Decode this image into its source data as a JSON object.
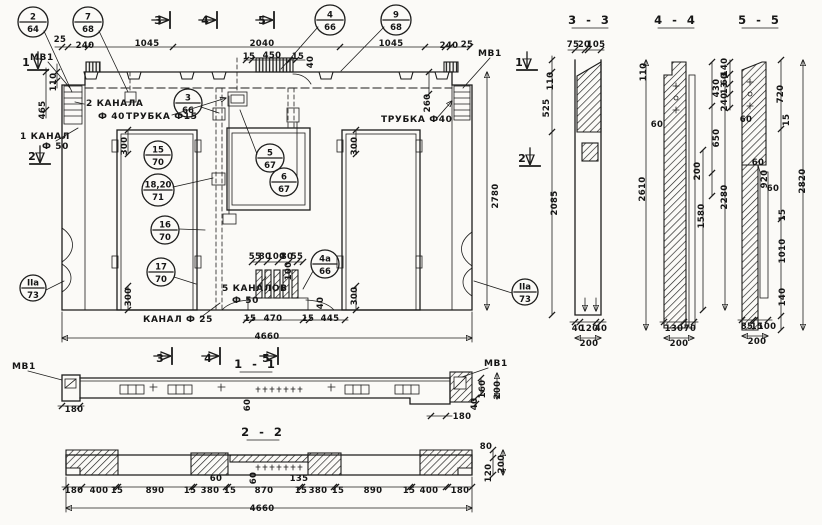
{
  "meta": {
    "bg": "#fbfaf7",
    "ink": "#1c1c1b",
    "drawing_type": "panel-working-drawing"
  },
  "drawing": {
    "balloons": [
      {
        "top": "2",
        "bot": "64",
        "cx": 33,
        "cy": 22,
        "r": 15
      },
      {
        "top": "7",
        "bot": "68",
        "cx": 88,
        "cy": 22,
        "r": 15
      },
      {
        "top": "4",
        "bot": "66",
        "cx": 330,
        "cy": 20,
        "r": 15
      },
      {
        "top": "9",
        "bot": "68",
        "cx": 396,
        "cy": 20,
        "r": 15
      },
      {
        "top": "3",
        "bot": "66",
        "cx": 188,
        "cy": 103,
        "r": 14
      },
      {
        "top": "15",
        "bot": "70",
        "cx": 158,
        "cy": 155,
        "r": 14
      },
      {
        "top": "18,20",
        "bot": "71",
        "cx": 158,
        "cy": 190,
        "r": 16
      },
      {
        "top": "16",
        "bot": "70",
        "cx": 165,
        "cy": 230,
        "r": 14
      },
      {
        "top": "17",
        "bot": "70",
        "cx": 161,
        "cy": 272,
        "r": 14
      },
      {
        "top": "5",
        "bot": "67",
        "cx": 270,
        "cy": 158,
        "r": 14
      },
      {
        "top": "6",
        "bot": "67",
        "cx": 284,
        "cy": 182,
        "r": 14
      },
      {
        "top": "4а",
        "bot": "66",
        "cx": 325,
        "cy": 264,
        "r": 14
      },
      {
        "top": "IIа",
        "bot": "73",
        "cx": 33,
        "cy": 288,
        "r": 13
      },
      {
        "top": "IIа",
        "bot": "73",
        "cx": 525,
        "cy": 292,
        "r": 13
      }
    ],
    "texts": [
      {
        "t": "25",
        "x": 60,
        "y": 42
      },
      {
        "t": "240",
        "x": 85,
        "y": 48
      },
      {
        "t": "1045",
        "x": 147,
        "y": 46
      },
      {
        "t": "2040",
        "x": 262,
        "y": 46
      },
      {
        "t": "1045",
        "x": 391,
        "y": 46
      },
      {
        "t": "240",
        "x": 449,
        "y": 48
      },
      {
        "t": "25",
        "x": 467,
        "y": 47
      },
      {
        "t": "15",
        "x": 249,
        "y": 59
      },
      {
        "t": "450",
        "x": 272,
        "y": 58
      },
      {
        "t": "15",
        "x": 298,
        "y": 59
      },
      {
        "t": "40",
        "x": 313,
        "y": 62,
        "r": 1
      },
      {
        "t": "3",
        "x": 158,
        "y": 24,
        "c": "mark",
        "n": "section-mark-3-top"
      },
      {
        "t": "4",
        "x": 205,
        "y": 24,
        "c": "mark",
        "n": "section-mark-4-top"
      },
      {
        "t": "5",
        "x": 262,
        "y": 24,
        "c": "mark",
        "n": "section-mark-5-top"
      },
      {
        "t": "1",
        "x": 26,
        "y": 66,
        "c": "mark",
        "n": "section-mark-1-left"
      },
      {
        "t": "2",
        "x": 32,
        "y": 160,
        "c": "mark",
        "n": "section-mark-2-left"
      },
      {
        "t": "1",
        "x": 519,
        "y": 66,
        "c": "mark",
        "n": "section-mark-1-right"
      },
      {
        "t": "2",
        "x": 522,
        "y": 162,
        "c": "mark",
        "n": "section-mark-2-right"
      },
      {
        "t": "МВ1",
        "x": 30,
        "y": 60,
        "c": "lbl",
        "n": "label-mv1-top-left"
      },
      {
        "t": "МВ1",
        "x": 478,
        "y": 56,
        "c": "lbl",
        "n": "label-mv1-top-right"
      },
      {
        "t": "110",
        "x": 56,
        "y": 82,
        "r": 1
      },
      {
        "t": "465",
        "x": 45,
        "y": 110,
        "r": 1
      },
      {
        "t": "2 КАНАЛА",
        "x": 86,
        "y": 106,
        "c": "lbl",
        "n": "label-2-channels"
      },
      {
        "t": "Ф 40",
        "x": 98,
        "y": 119,
        "c": "lbl",
        "n": "label-2-channels-dia"
      },
      {
        "t": "ТРУБКА Ф15",
        "x": 126,
        "y": 119,
        "c": "lbl",
        "n": "label-tube-15"
      },
      {
        "t": "1 КАНАЛ",
        "x": 20,
        "y": 139,
        "c": "lbl",
        "n": "label-1-channel"
      },
      {
        "t": "Ф 50",
        "x": 42,
        "y": 149,
        "c": "lbl",
        "n": "label-1-channel-dia"
      },
      {
        "t": "ТРУБКА Ф40",
        "x": 381,
        "y": 122,
        "c": "lbl",
        "n": "label-tube-40"
      },
      {
        "t": "260",
        "x": 430,
        "y": 103,
        "r": 1
      },
      {
        "t": "300",
        "x": 127,
        "y": 146,
        "r": 1
      },
      {
        "t": "300",
        "x": 131,
        "y": 297,
        "r": 1
      },
      {
        "t": "300",
        "x": 357,
        "y": 146,
        "r": 1
      },
      {
        "t": "300",
        "x": 357,
        "y": 296,
        "r": 1
      },
      {
        "t": "2780",
        "x": 498,
        "y": 196,
        "r": 1
      },
      {
        "t": "55",
        "x": 255,
        "y": 259
      },
      {
        "t": "80",
        "x": 265,
        "y": 259
      },
      {
        "t": "100",
        "x": 276,
        "y": 259
      },
      {
        "t": "80",
        "x": 287,
        "y": 259
      },
      {
        "t": "55",
        "x": 297,
        "y": 259
      },
      {
        "t": "100",
        "x": 291,
        "y": 271,
        "r": 1
      },
      {
        "t": "5 КАНАЛОВ",
        "x": 222,
        "y": 291,
        "c": "lbl",
        "n": "label-5-channels"
      },
      {
        "t": "Ф 50",
        "x": 232,
        "y": 303,
        "c": "lbl",
        "n": "label-5-channels-dia"
      },
      {
        "t": "КАНАЛ Ф 25",
        "x": 143,
        "y": 322,
        "c": "lbl",
        "n": "label-channel-25"
      },
      {
        "t": "40",
        "x": 323,
        "y": 303,
        "r": 1
      },
      {
        "t": "15",
        "x": 250,
        "y": 321
      },
      {
        "t": "470",
        "x": 273,
        "y": 321
      },
      {
        "t": "15",
        "x": 308,
        "y": 321
      },
      {
        "t": "445",
        "x": 330,
        "y": 321
      },
      {
        "t": "4660",
        "x": 267,
        "y": 339
      },
      {
        "t": "3",
        "x": 160,
        "y": 362,
        "c": "mark",
        "n": "section-mark-3-bottom"
      },
      {
        "t": "4",
        "x": 208,
        "y": 362,
        "c": "mark",
        "n": "section-mark-4-bottom"
      },
      {
        "t": "5",
        "x": 266,
        "y": 362,
        "c": "mark",
        "n": "section-mark-5-bottom"
      },
      {
        "t": "3 - 3",
        "x": 590,
        "y": 24,
        "c": "title",
        "n": "section-title-3-3"
      },
      {
        "t": "4 - 4",
        "x": 676,
        "y": 24,
        "c": "title",
        "n": "section-title-4-4"
      },
      {
        "t": "5 - 5",
        "x": 760,
        "y": 24,
        "c": "title",
        "n": "section-title-5-5"
      },
      {
        "t": "1 - 1",
        "x": 256,
        "y": 368,
        "c": "title",
        "n": "section-title-1-1"
      },
      {
        "t": "2 - 2",
        "x": 263,
        "y": 436,
        "c": "title",
        "n": "section-title-2-2"
      },
      {
        "t": "75",
        "x": 573,
        "y": 47
      },
      {
        "t": "20",
        "x": 584,
        "y": 47
      },
      {
        "t": "105",
        "x": 596,
        "y": 47
      },
      {
        "t": "110",
        "x": 553,
        "y": 81,
        "r": 1
      },
      {
        "t": "525",
        "x": 549,
        "y": 108,
        "r": 1
      },
      {
        "t": "2085",
        "x": 557,
        "y": 203,
        "r": 1
      },
      {
        "t": "40",
        "x": 578,
        "y": 331
      },
      {
        "t": "120",
        "x": 589,
        "y": 331
      },
      {
        "t": "40",
        "x": 601,
        "y": 331
      },
      {
        "t": "200",
        "x": 589,
        "y": 346
      },
      {
        "t": "110",
        "x": 646,
        "y": 72,
        "r": 1
      },
      {
        "t": "60",
        "x": 657,
        "y": 127
      },
      {
        "t": "430",
        "x": 719,
        "y": 88,
        "r": 1
      },
      {
        "t": "650",
        "x": 719,
        "y": 138,
        "r": 1
      },
      {
        "t": "200",
        "x": 700,
        "y": 171,
        "r": 1
      },
      {
        "t": "1580",
        "x": 704,
        "y": 216,
        "r": 1
      },
      {
        "t": "2280",
        "x": 727,
        "y": 197,
        "r": 1
      },
      {
        "t": "2610",
        "x": 645,
        "y": 189,
        "r": 1
      },
      {
        "t": "130",
        "x": 674,
        "y": 331
      },
      {
        "t": "70",
        "x": 690,
        "y": 331
      },
      {
        "t": "200",
        "x": 679,
        "y": 346
      },
      {
        "t": "140",
        "x": 727,
        "y": 67,
        "r": 1
      },
      {
        "t": "60",
        "x": 727,
        "y": 79,
        "r": 1
      },
      {
        "t": "13",
        "x": 727,
        "y": 88,
        "r": 1
      },
      {
        "t": "240",
        "x": 727,
        "y": 102,
        "r": 1
      },
      {
        "t": "60",
        "x": 746,
        "y": 122
      },
      {
        "t": "720",
        "x": 783,
        "y": 94,
        "r": 1
      },
      {
        "t": "15",
        "x": 789,
        "y": 120,
        "r": 1
      },
      {
        "t": "60",
        "x": 758,
        "y": 165
      },
      {
        "t": "920",
        "x": 767,
        "y": 179,
        "r": 1
      },
      {
        "t": "60",
        "x": 773,
        "y": 191
      },
      {
        "t": "2820",
        "x": 805,
        "y": 181,
        "r": 1
      },
      {
        "t": "15",
        "x": 785,
        "y": 215,
        "r": 1
      },
      {
        "t": "1010",
        "x": 785,
        "y": 251,
        "r": 1
      },
      {
        "t": "140",
        "x": 785,
        "y": 297,
        "r": 1
      },
      {
        "t": "85",
        "x": 747,
        "y": 329
      },
      {
        "t": "15",
        "x": 757,
        "y": 329
      },
      {
        "t": "100",
        "x": 767,
        "y": 329
      },
      {
        "t": "200",
        "x": 757,
        "y": 344
      },
      {
        "t": "МВ1",
        "x": 12,
        "y": 369,
        "c": "lbl",
        "n": "label-mv1-1-1-left"
      },
      {
        "t": "180",
        "x": 74,
        "y": 412
      },
      {
        "t": "60",
        "x": 250,
        "y": 405,
        "r": 1
      },
      {
        "t": "МВ1",
        "x": 484,
        "y": 366,
        "c": "lbl",
        "n": "label-mv1-1-1-right"
      },
      {
        "t": "160",
        "x": 485,
        "y": 389,
        "r": 1
      },
      {
        "t": "200",
        "x": 500,
        "y": 390,
        "r": 1
      },
      {
        "t": "40",
        "x": 477,
        "y": 404,
        "r": 1
      },
      {
        "t": "180",
        "x": 462,
        "y": 419
      },
      {
        "t": "180",
        "x": 74,
        "y": 493
      },
      {
        "t": "400",
        "x": 99,
        "y": 493
      },
      {
        "t": "15",
        "x": 117,
        "y": 493
      },
      {
        "t": "890",
        "x": 155,
        "y": 493
      },
      {
        "t": "15",
        "x": 190,
        "y": 493
      },
      {
        "t": "60",
        "x": 216,
        "y": 481
      },
      {
        "t": "380",
        "x": 210,
        "y": 493
      },
      {
        "t": "15",
        "x": 230,
        "y": 493
      },
      {
        "t": "60",
        "x": 256,
        "y": 478,
        "r": 1
      },
      {
        "t": "870",
        "x": 264,
        "y": 493
      },
      {
        "t": "135",
        "x": 299,
        "y": 481
      },
      {
        "t": "15",
        "x": 301,
        "y": 493
      },
      {
        "t": "380",
        "x": 318,
        "y": 493
      },
      {
        "t": "15",
        "x": 338,
        "y": 493
      },
      {
        "t": "890",
        "x": 373,
        "y": 493
      },
      {
        "t": "15",
        "x": 409,
        "y": 493
      },
      {
        "t": "400",
        "x": 429,
        "y": 493
      },
      {
        "t": "180",
        "x": 460,
        "y": 493
      },
      {
        "t": "80",
        "x": 486,
        "y": 449
      },
      {
        "t": "120",
        "x": 491,
        "y": 473,
        "r": 1
      },
      {
        "t": "200",
        "x": 504,
        "y": 464,
        "r": 1
      },
      {
        "t": "4660",
        "x": 262,
        "y": 511
      }
    ]
  }
}
